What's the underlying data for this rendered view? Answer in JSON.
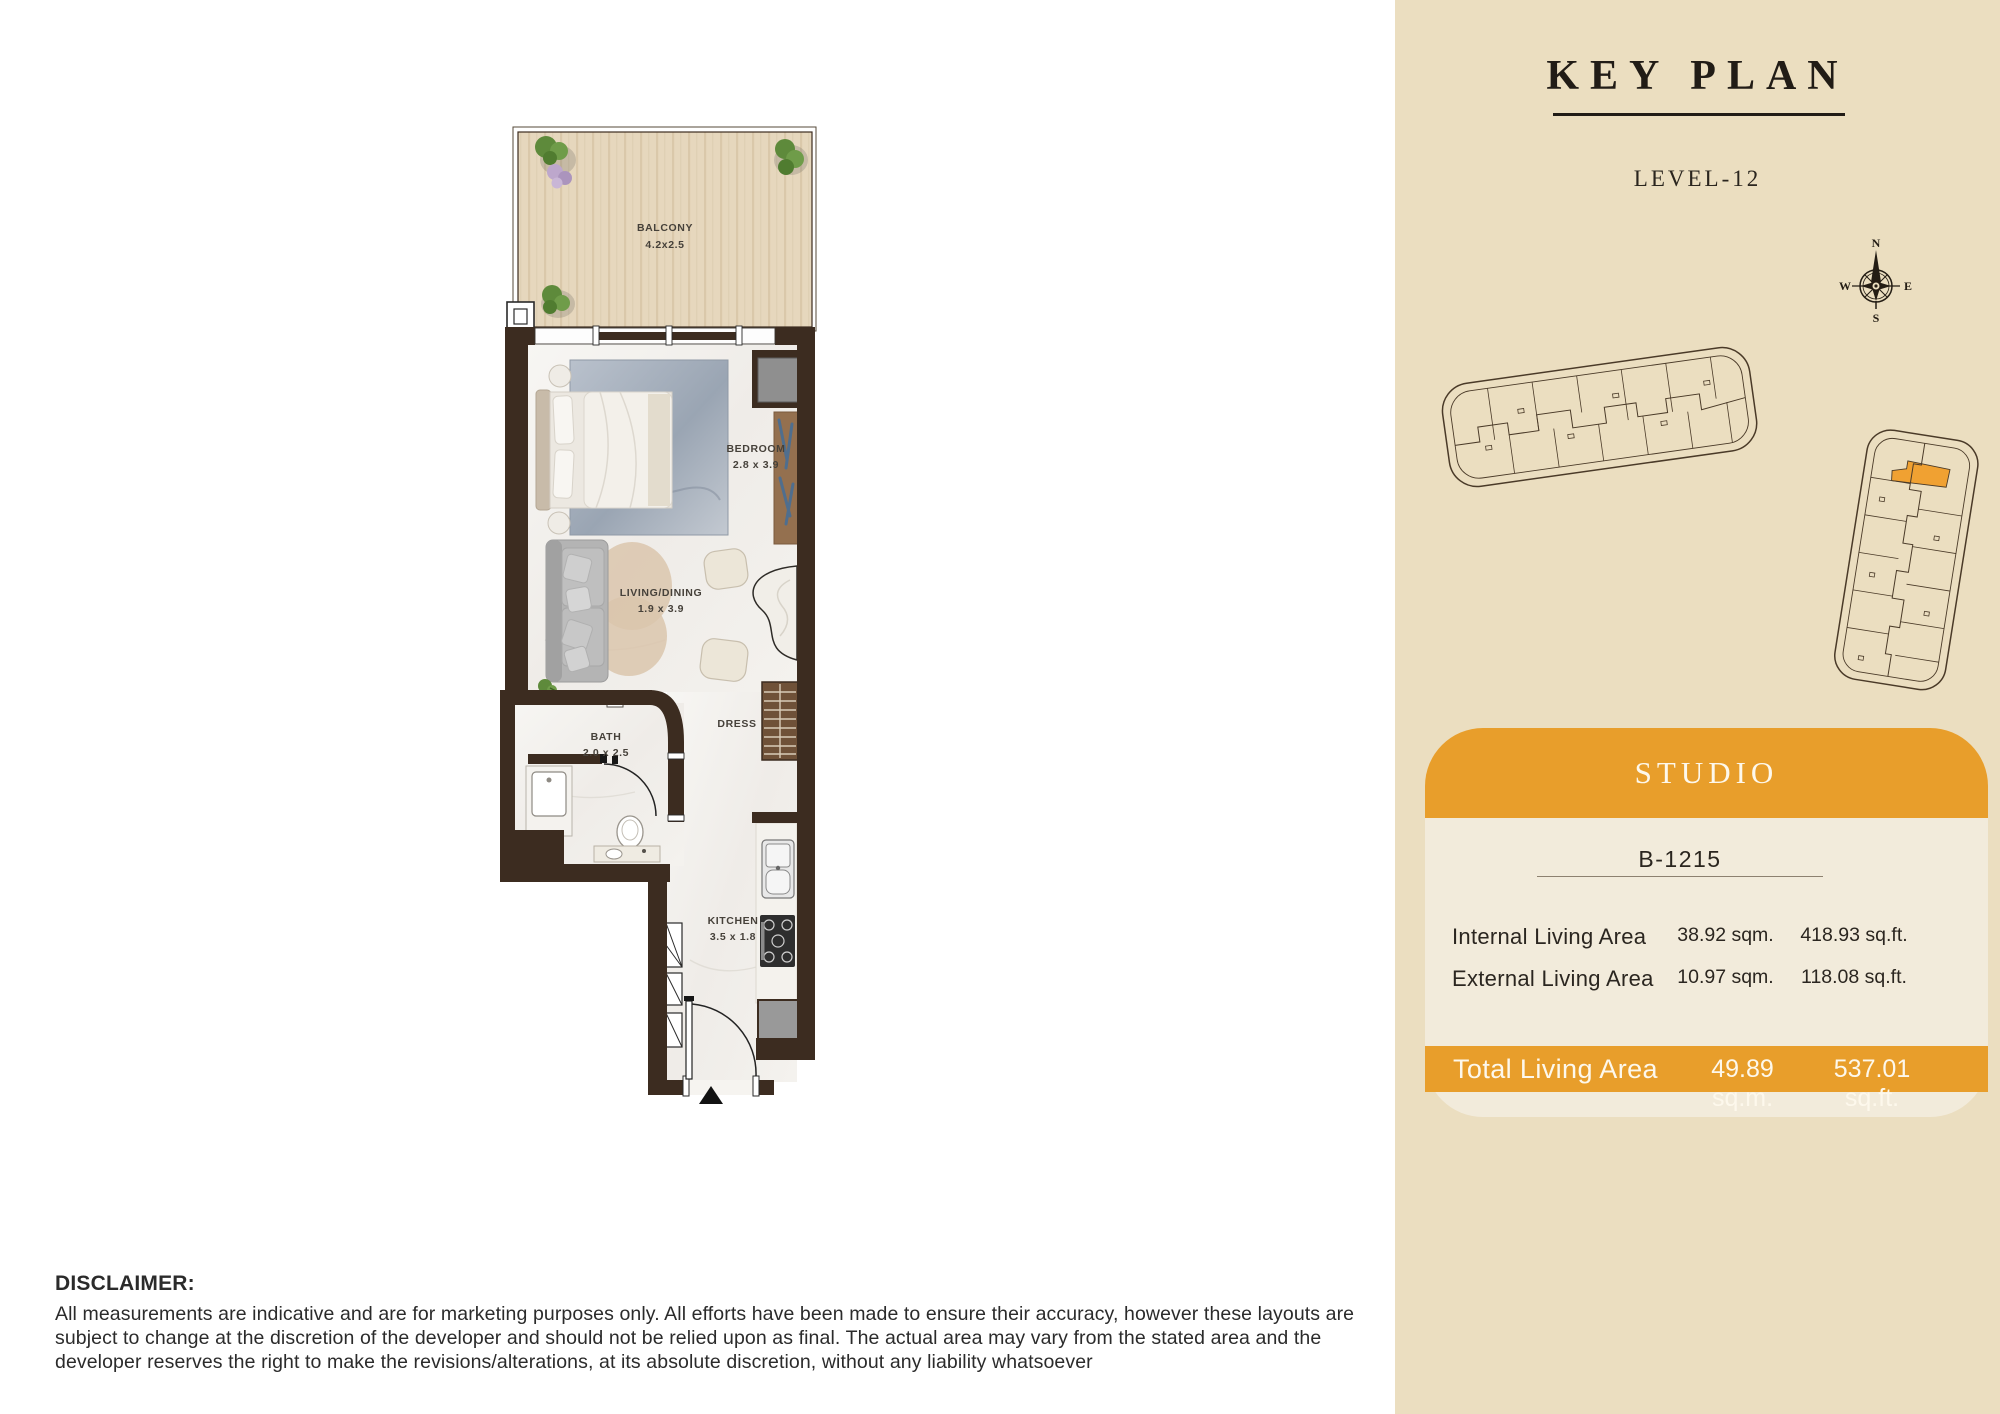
{
  "floorplan": {
    "rooms": {
      "balcony": {
        "name": "BALCONY",
        "dims": "4.2x2.5"
      },
      "bedroom": {
        "name": "BEDROOM",
        "dims": "2.8 x 3.9"
      },
      "living_dining": {
        "name": "LIVING/DINING",
        "dims": "1.9 x 3.9"
      },
      "bath": {
        "name": "BATH",
        "dims": "2.0 x 2.5"
      },
      "dress": {
        "name": "DRESS"
      },
      "kitchen": {
        "name": "KITCHEN",
        "dims": "3.5 x 1.8"
      }
    }
  },
  "key_plan": {
    "title": "KEY PLAN",
    "level": "LEVEL-12",
    "compass": {
      "n": "N",
      "e": "E",
      "s": "S",
      "w": "W"
    },
    "highlight_color": "#F0A132",
    "panel_color": "#EBDEC0"
  },
  "unit_card": {
    "type_label": "STUDIO",
    "unit_number": "B-1215",
    "accent_color": "#E89E2B",
    "rows": [
      {
        "label": "Internal Living Area",
        "metric": "38.92 sqm.",
        "imperial": "418.93 sq.ft."
      },
      {
        "label": "External Living Area",
        "metric": "10.97 sqm.",
        "imperial": "118.08 sq.ft."
      }
    ],
    "total": {
      "label": "Total Living Area",
      "metric": "49.89 sq.m.",
      "imperial": "537.01 sq.ft."
    }
  },
  "disclaimer": {
    "heading": "DISCLAIMER:",
    "body": "All measurements are indicative and are for marketing purposes only. All efforts have been made to ensure their accuracy, however these layouts are subject to change at the discretion of the developer and should not be relied upon as final. The actual area may vary from the stated area and the developer reserves the right to make the revisions/alterations, at its absolute discretion, without any liability whatsoever"
  }
}
